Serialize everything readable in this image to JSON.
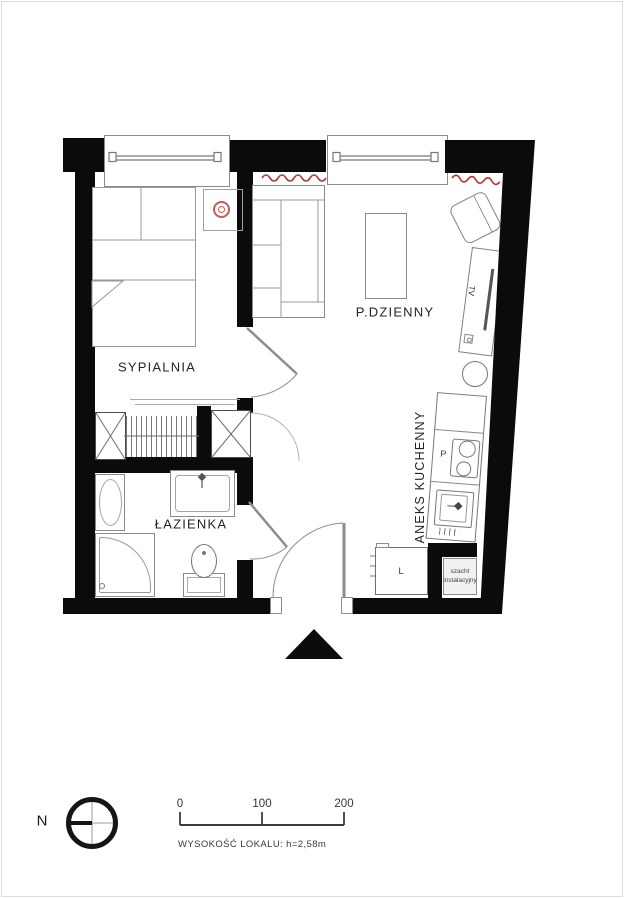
{
  "colors": {
    "wall": "#0b0b0b",
    "furniture_line": "#8a8a8a",
    "radiator_red": "#b03434",
    "nightstand_symbol_red": "#cc5a5a"
  },
  "rooms": {
    "bedroom": "SYPIALNIA",
    "living_room": "P.DZIENNY",
    "bathroom": "ŁAZIENKA",
    "kitchenette": "ANEKS KUCHENNY"
  },
  "labels": {
    "tv": "TV",
    "hob": "P",
    "fridge": "L",
    "shaft_line1": "szacht",
    "shaft_line2": "instalacyjny"
  },
  "compass": {
    "north": "N"
  },
  "scale_bar": {
    "tick0": "0",
    "tick100": "100",
    "tick200": "200"
  },
  "footer": {
    "height_note": "WYSOKOŚĆ LOKALU: h=2,58m"
  }
}
